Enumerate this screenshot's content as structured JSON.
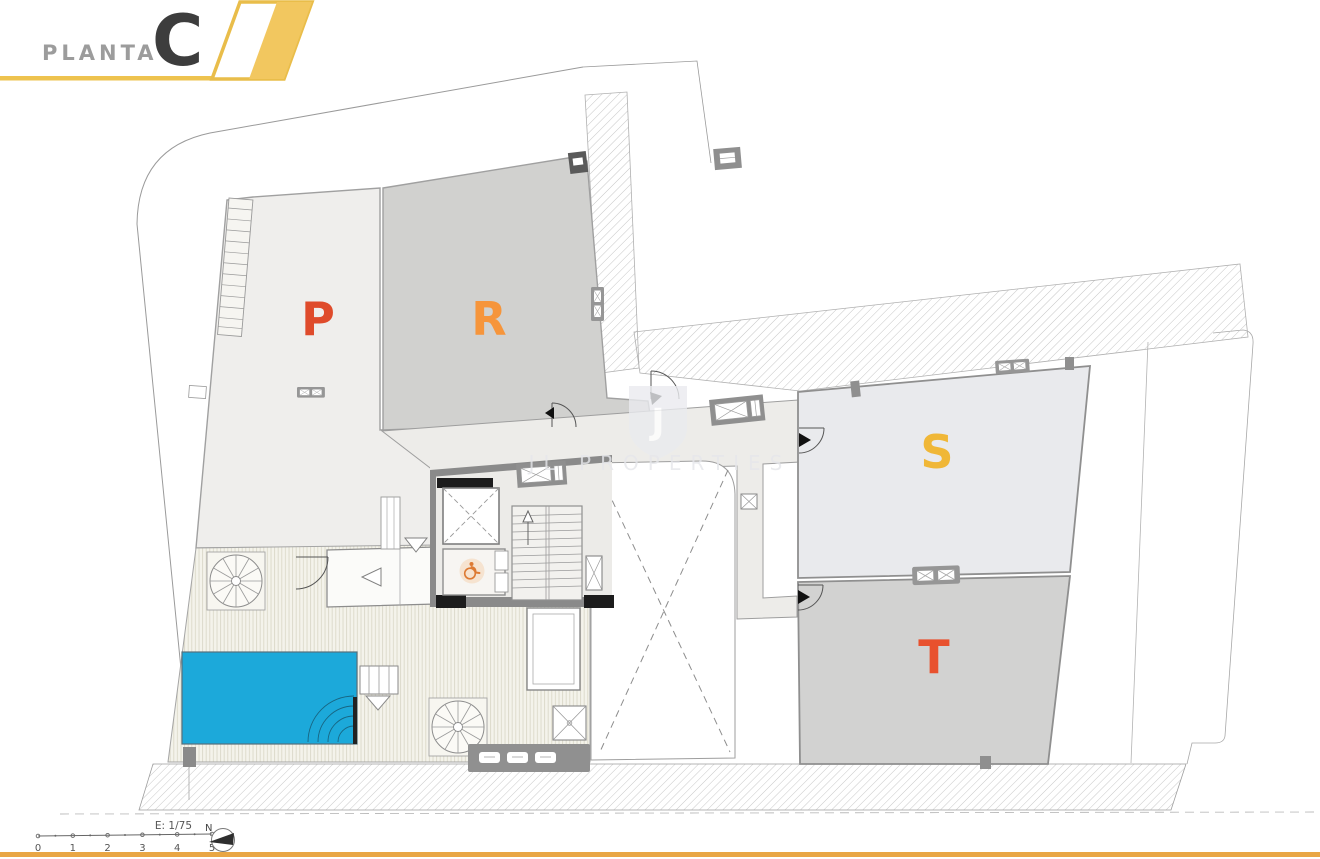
{
  "header": {
    "title": "PLANTA",
    "floor_letter": "C"
  },
  "units": [
    {
      "name": "P",
      "label_color": "#df4b2b",
      "region_color": "#efeeec"
    },
    {
      "name": "R",
      "label_color": "#f6953b",
      "region_color": "#d1d1cf"
    },
    {
      "name": "S",
      "label_color": "#f0b737",
      "region_color": "#e9eaed"
    },
    {
      "name": "T",
      "label_color": "#e8512e",
      "region_color": "#d2d2d1"
    }
  ],
  "watermark": {
    "initial": "J",
    "brand": "JL PROPERTIES"
  },
  "footer": {
    "scale_label": "E: 1/75",
    "north_label": "N",
    "ruler_ticks": [
      "0",
      "1",
      "2",
      "3",
      "4",
      "5"
    ]
  },
  "palette": {
    "banner_yellow": "#f2c75f",
    "banner_outline": "#e9bd4a",
    "rule_yellow": "#eec34f",
    "footer_rule_orange": "#e9a644",
    "pool_blue": "#1ca9da"
  }
}
